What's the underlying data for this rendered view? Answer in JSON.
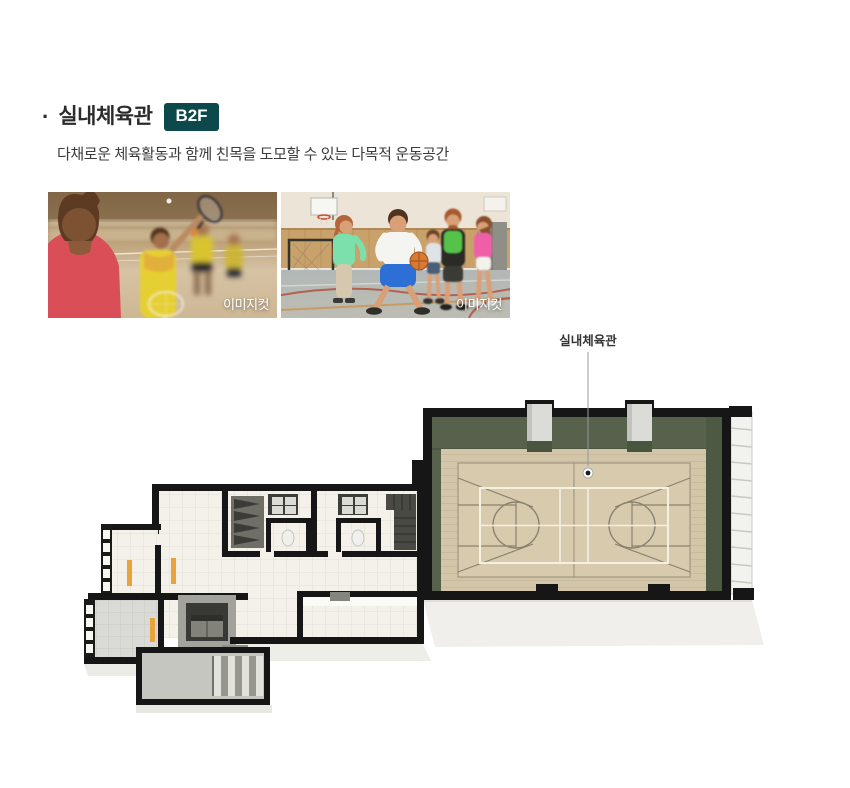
{
  "section": {
    "bullet": "·",
    "title": "실내체육관",
    "floor_badge": "B2F",
    "description": "다채로운 체육활동과 함께 친목을 도모할 수 있는 다목적 운동공간"
  },
  "photos": [
    {
      "name": "badminton-photo",
      "watermark": "이미지컷"
    },
    {
      "name": "basketball-photo",
      "watermark": "이미지컷"
    }
  ],
  "floor_plan": {
    "label": "실내체육관",
    "marker": "location-dot"
  },
  "colors": {
    "badge_bg": "#0d494b",
    "plan_wall": "#161616",
    "gym_wall_green": "#57614c",
    "gym_floor_tan": "#d2c5a8",
    "court_line_white": "#f4f0e2",
    "court_line_gray": "#a09780",
    "bench_orange": "#e8a33d"
  }
}
